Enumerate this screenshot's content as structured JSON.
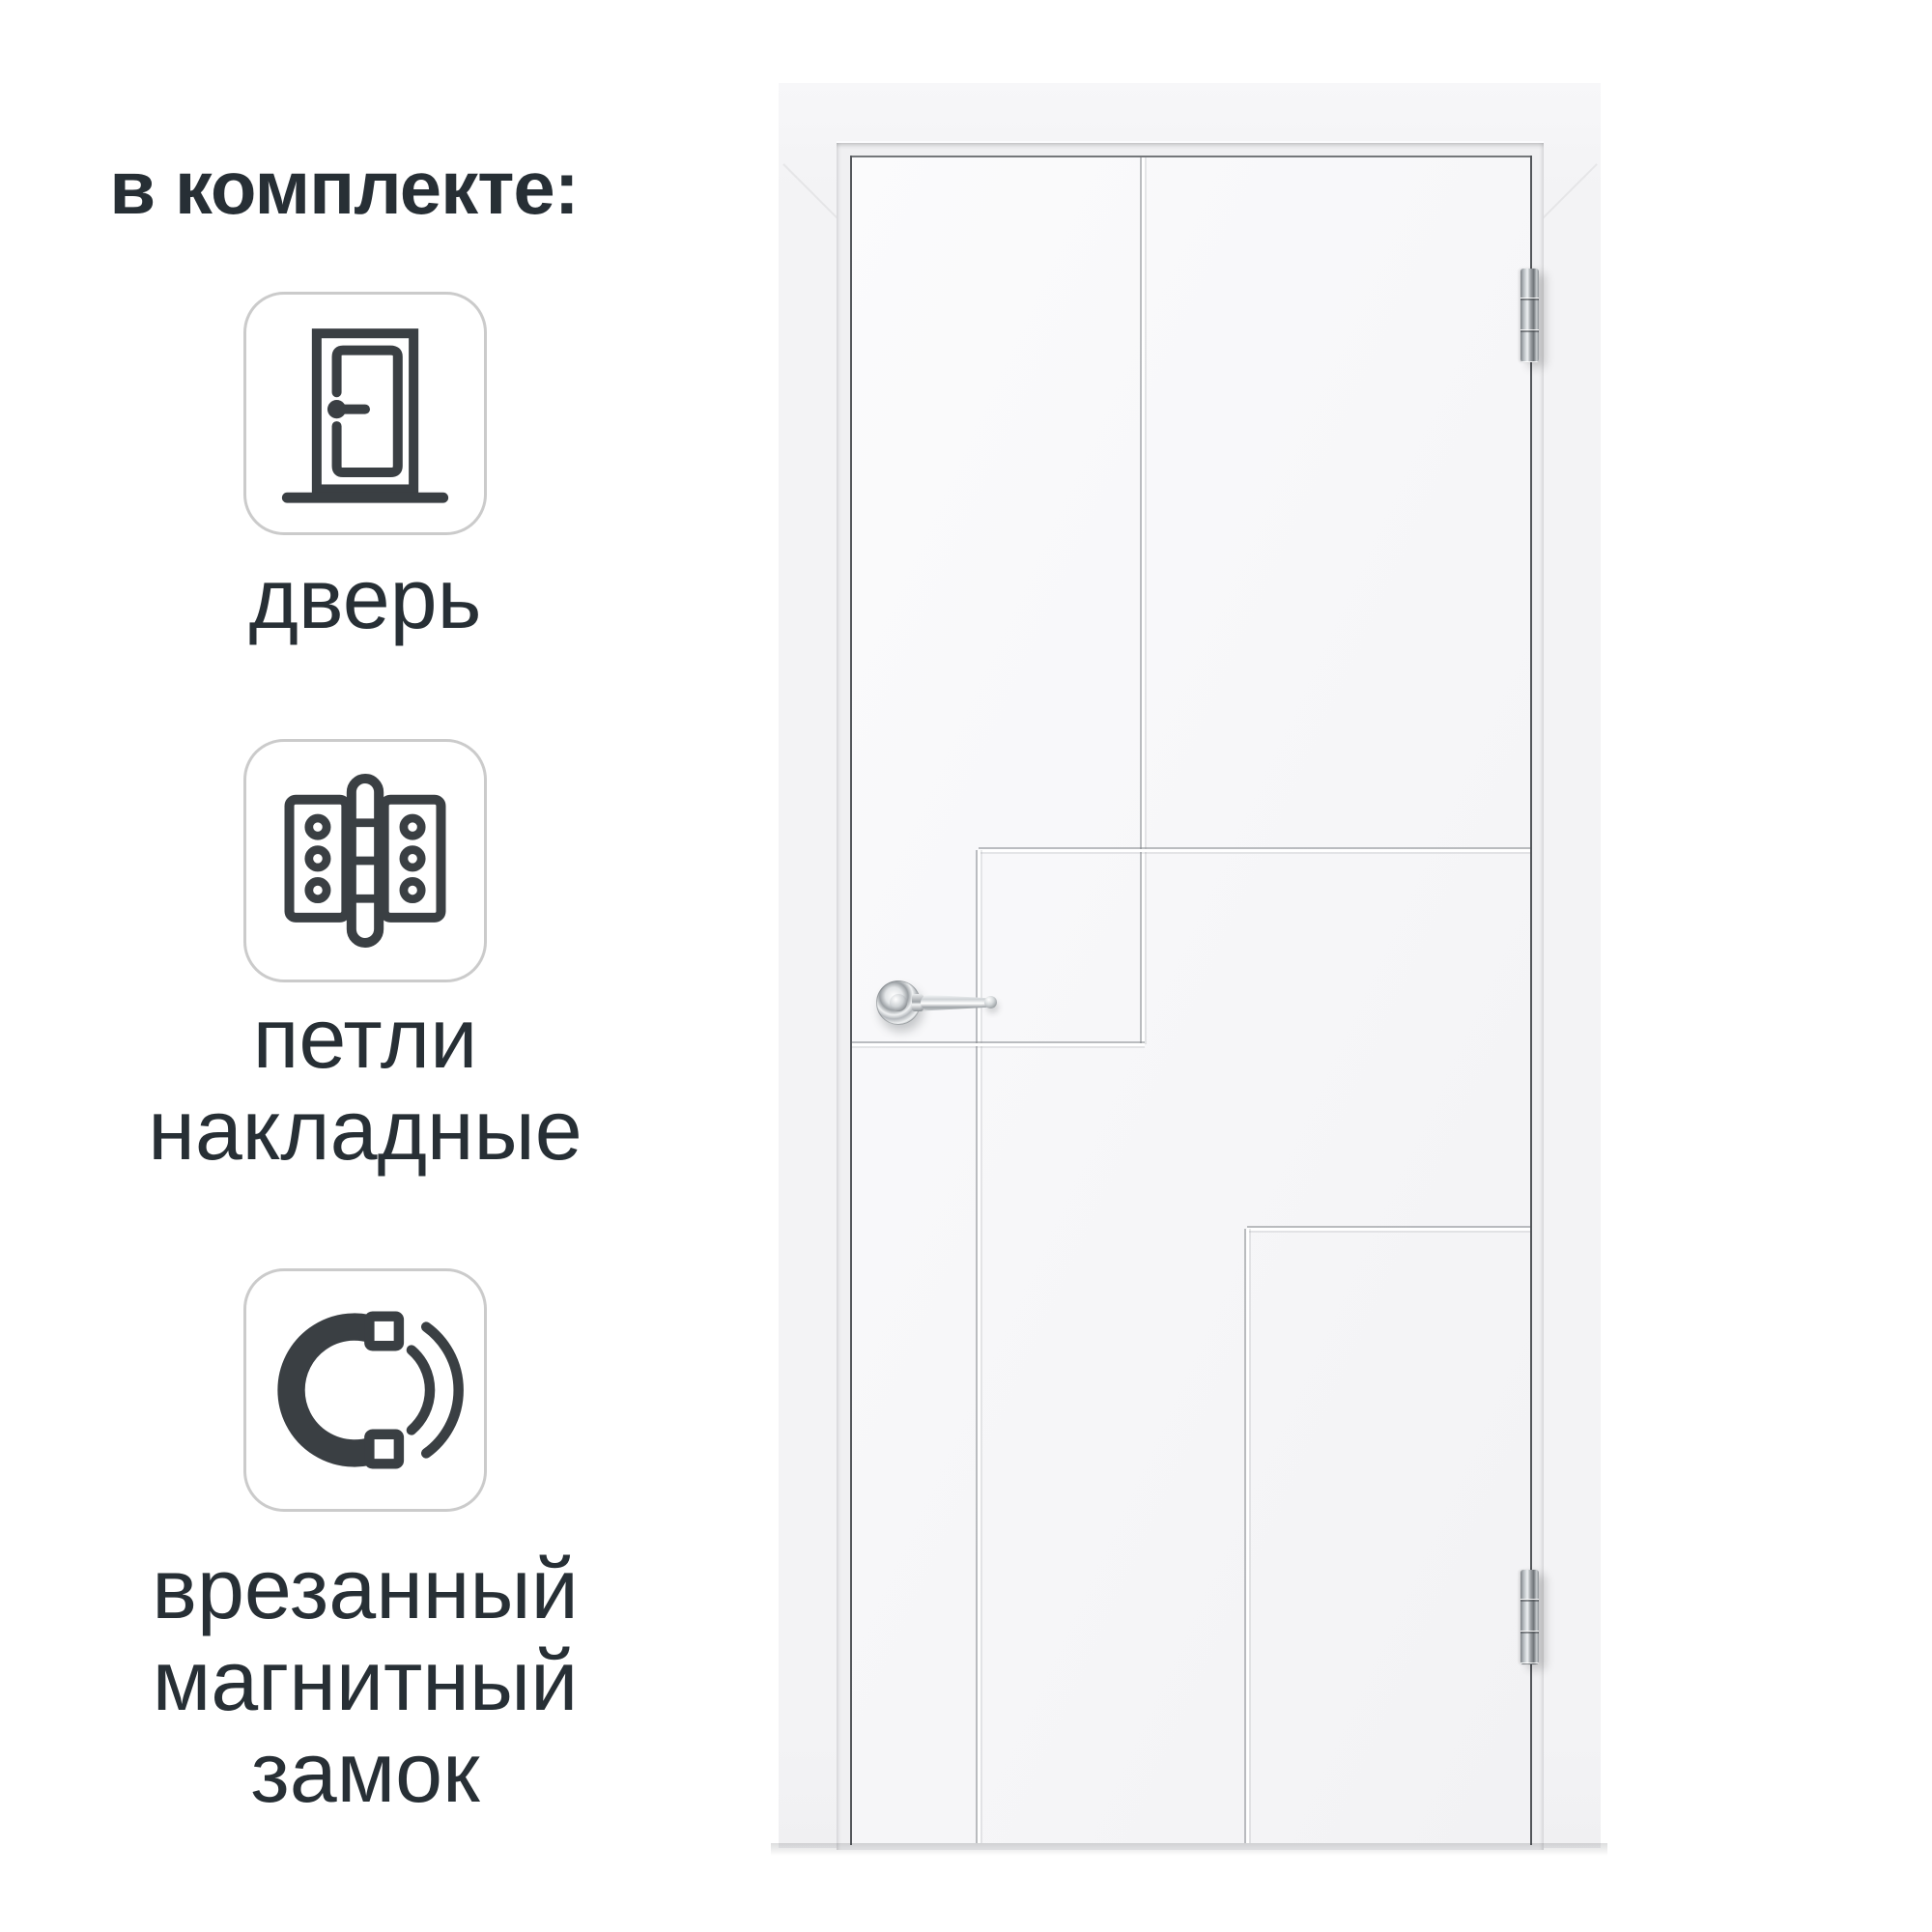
{
  "title": {
    "text": "в комплекте:"
  },
  "included": {
    "items": [
      {
        "name": "door",
        "icon": "door-icon",
        "label_lines": [
          "дверь"
        ]
      },
      {
        "name": "hinges",
        "icon": "hinge-icon",
        "label_lines": [
          "петли",
          "накладные"
        ]
      },
      {
        "name": "magnetic-lock",
        "icon": "magnet-icon",
        "label_lines": [
          "врезанный",
          "магнитный",
          "замок"
        ]
      }
    ]
  },
  "product": {
    "object": "white interior door leaf in white frame",
    "hinge_positions": [
      "top-right",
      "bottom-right"
    ],
    "handle": "chrome lever on left side",
    "hardware_finish": "chrome"
  },
  "colors": {
    "background": "#ffffff",
    "text": "#272f35",
    "card_border": "#cbcbcb",
    "icon_stroke": "#3a3f43",
    "door_surface": "#f6f6f8",
    "frame_surface": "#f3f3f5",
    "gap_line": "#54575b"
  }
}
